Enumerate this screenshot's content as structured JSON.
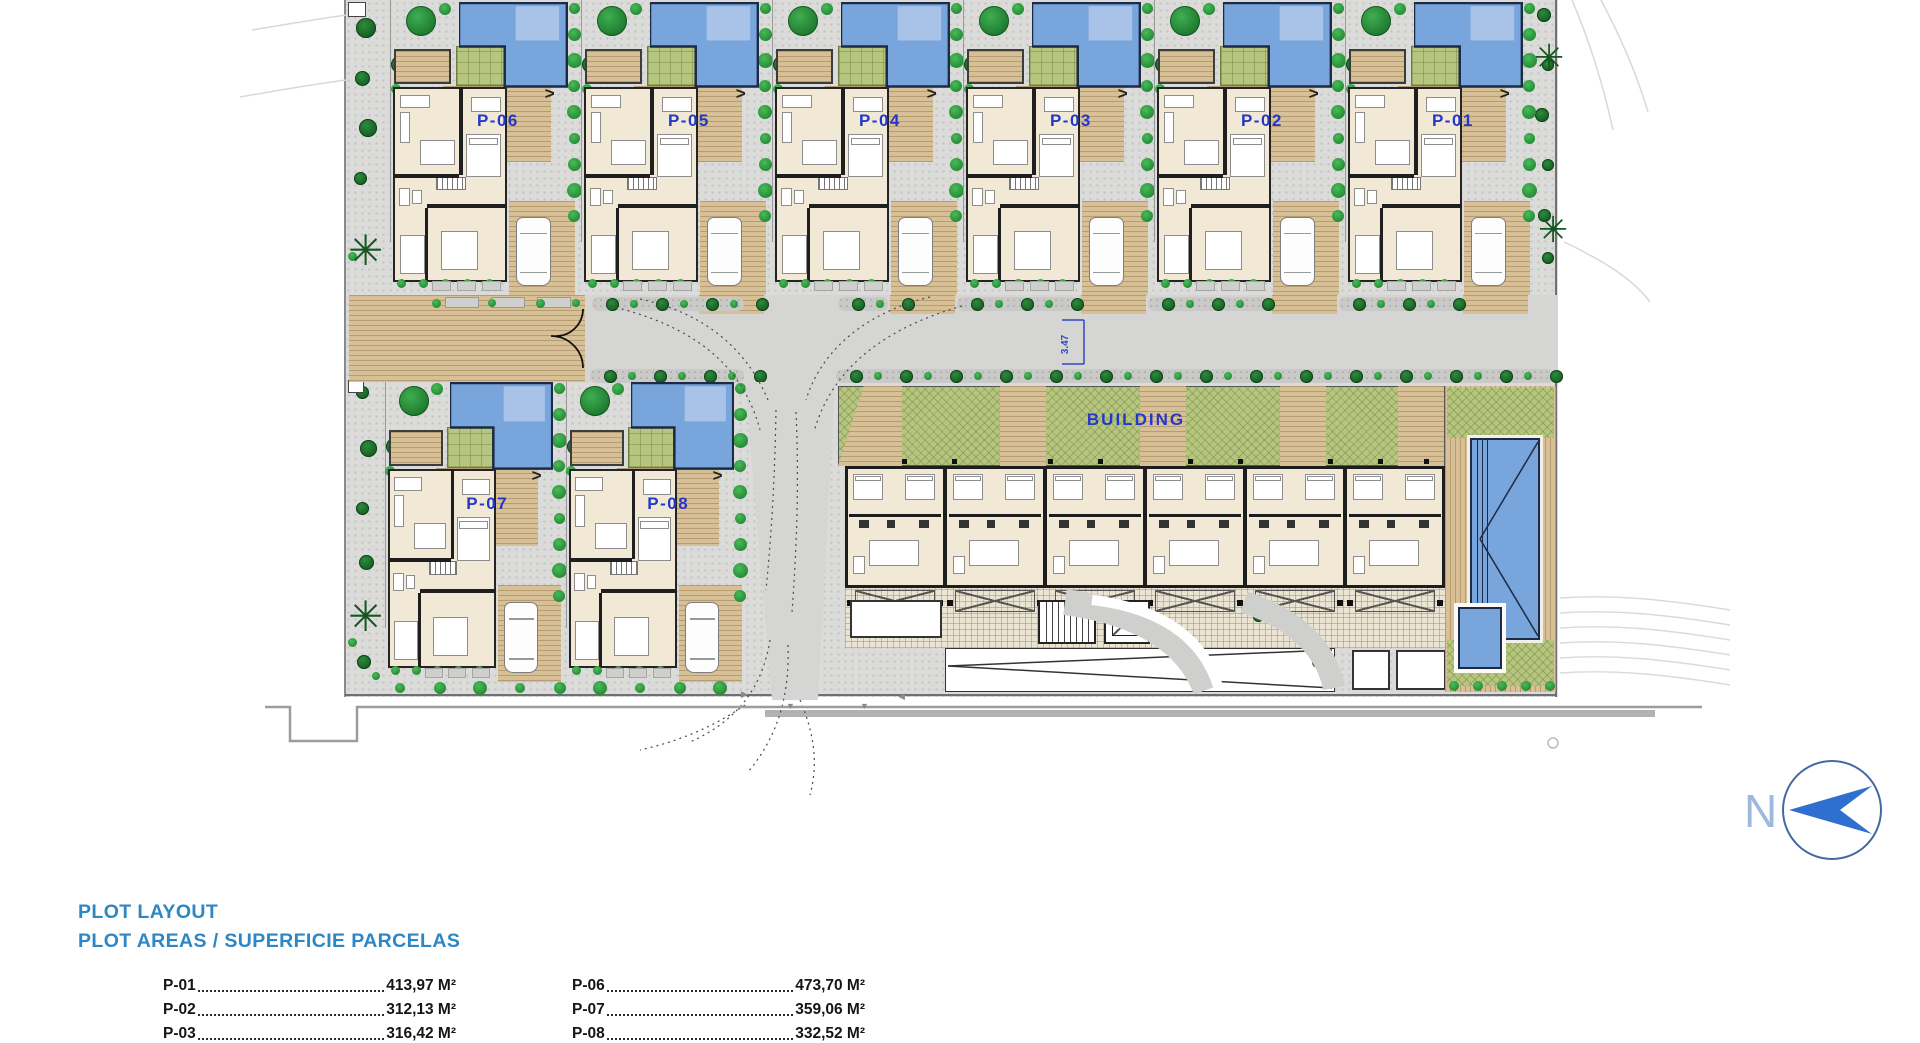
{
  "plan": {
    "top_row_plots": [
      "P-06",
      "P-05",
      "P-04",
      "P-03",
      "P-02",
      "P-01"
    ],
    "bottom_row_plots": [
      "P-07",
      "P-08"
    ],
    "building_label": "BUILDING",
    "road_dimension_label": "3.47",
    "north_label": "N",
    "deck_arrow": ">"
  },
  "legend": {
    "title_line1": "PLOT LAYOUT",
    "title_line2": "PLOT AREAS / SUPERFICIE PARCELAS",
    "columns": [
      {
        "rows": [
          {
            "plot": "P-01",
            "area": "413,97 M²"
          },
          {
            "plot": "P-02",
            "area": "312,13 M²"
          },
          {
            "plot": "P-03",
            "area": "316,42 M²"
          }
        ]
      },
      {
        "rows": [
          {
            "plot": "P-06",
            "area": "473,70 M²"
          },
          {
            "plot": "P-07",
            "area": "359,06 M²"
          },
          {
            "plot": "P-08",
            "area": "332,52 M²"
          }
        ]
      }
    ]
  },
  "colors": {
    "pool": "#78a5dc",
    "pool_step": "#a9c3e8",
    "pool_border": "#1c2a45",
    "lawn": "#b7c67e",
    "deck": "#d8c096",
    "paving": "#dbdbd9",
    "road": "#d5d5d3",
    "house": "#f1e9d6",
    "wall": "#1f1f1f",
    "tree": "#2c8c3c",
    "shrub": "#35a545",
    "label_blue": "#2438c8",
    "title_blue": "#2e86c5",
    "north_blue": "#2e6fd0",
    "north_letter": "#9db9dd",
    "dim_blue": "#2f49c3"
  }
}
